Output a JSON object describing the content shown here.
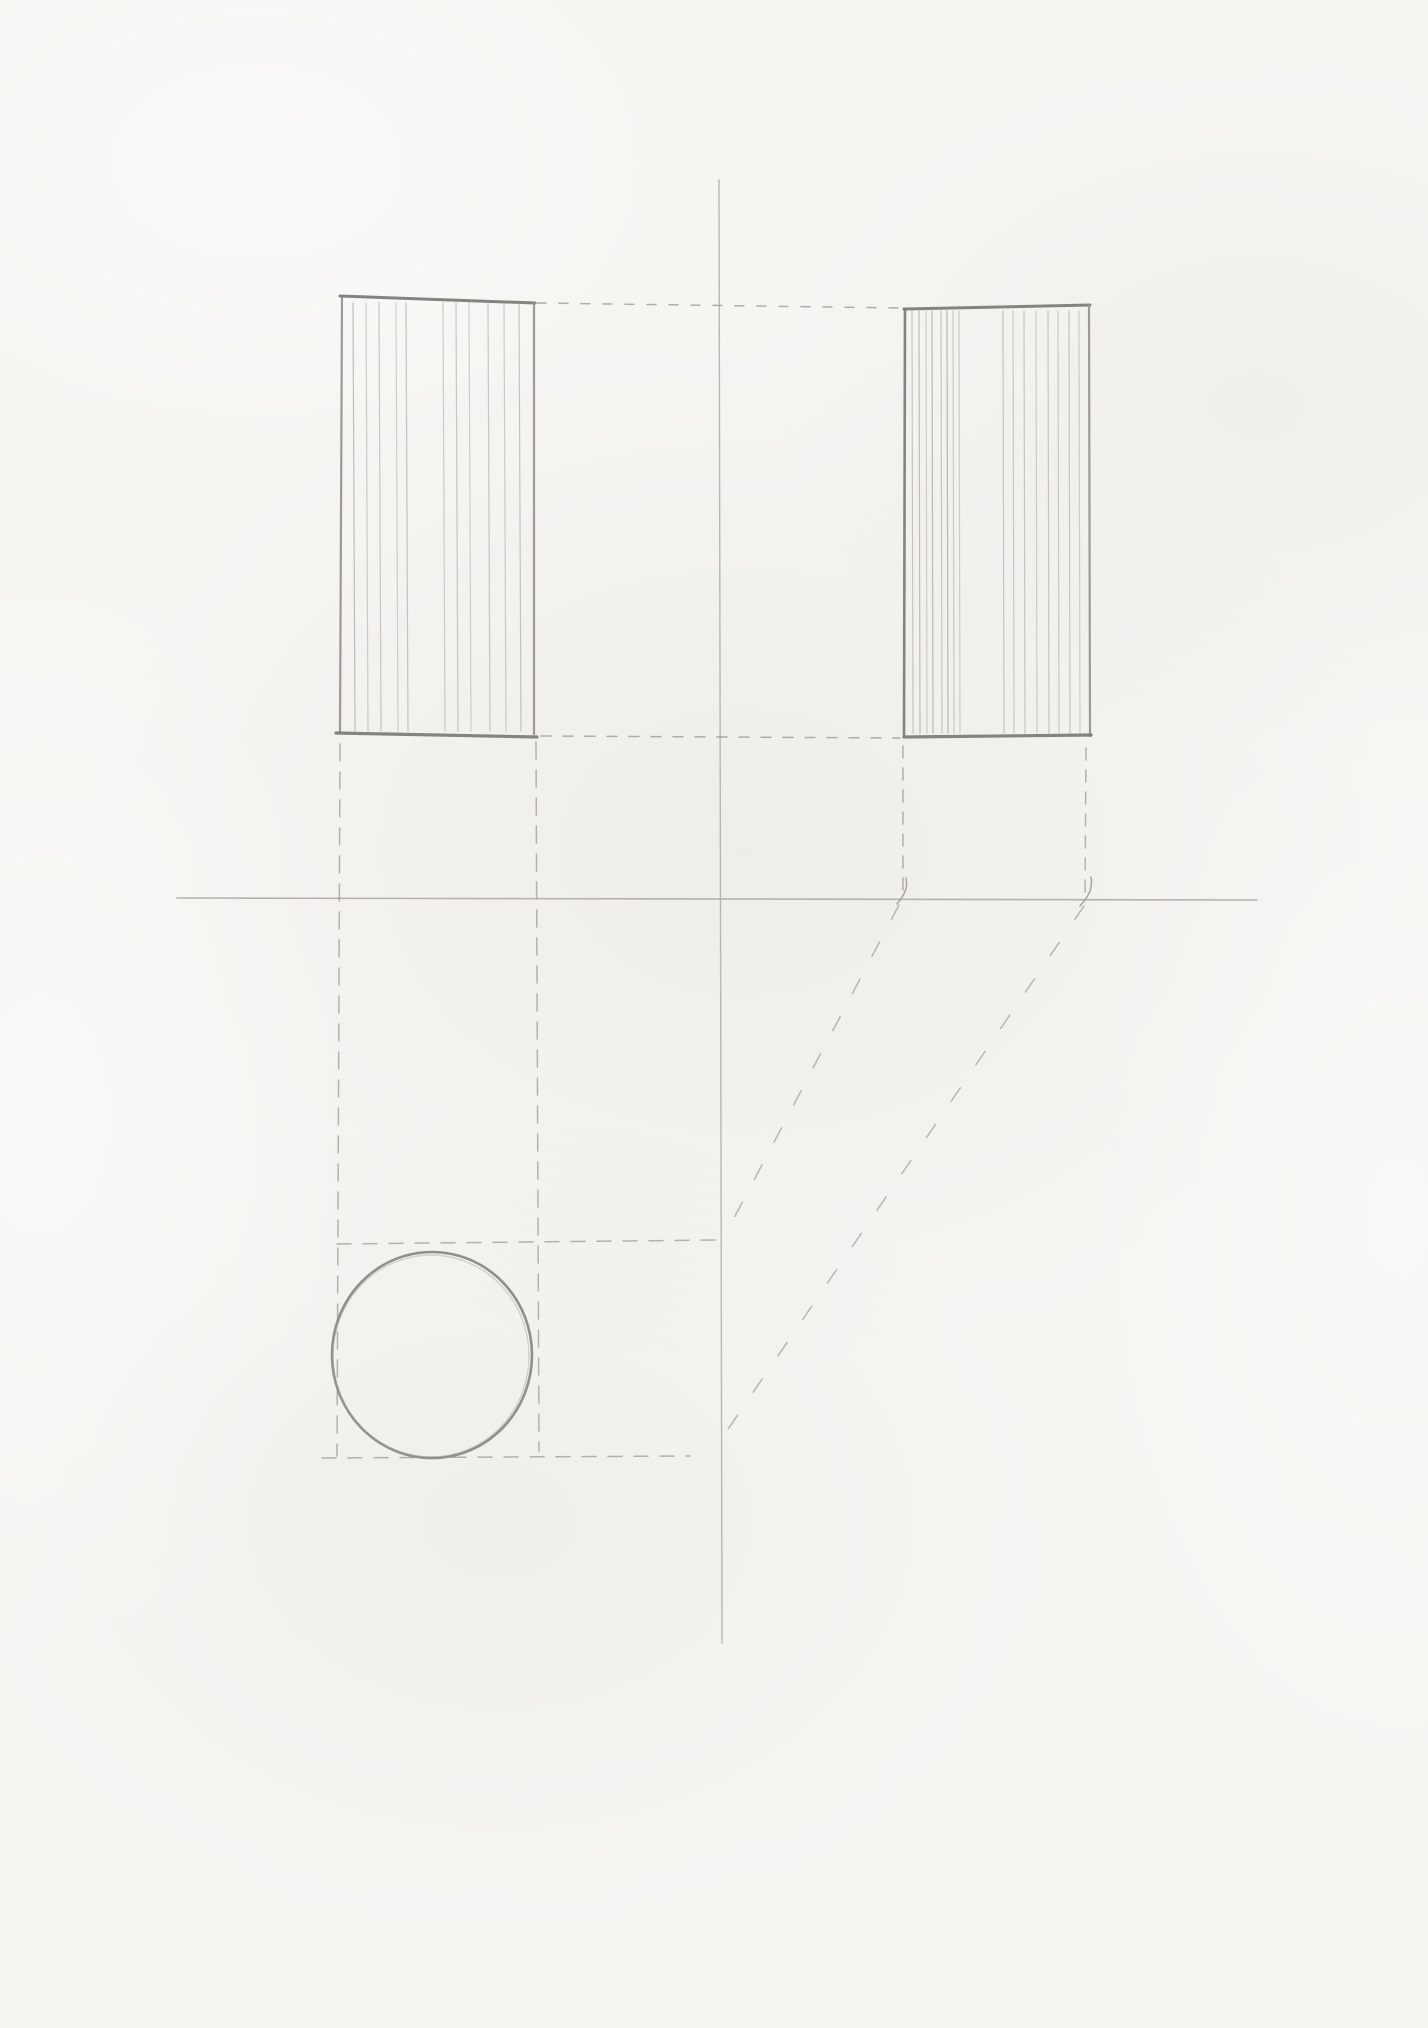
{
  "canvas": {
    "width": 1428,
    "height": 2028
  },
  "palette": {
    "paper": "#f6f5f2",
    "pencilFaint": "#c2bfba",
    "pencilLight": "#aaa7a1",
    "pencilMid": "#98958f",
    "pencilDark": "#7e7c77",
    "pencilOutline": "#8b8984"
  },
  "drawing": {
    "lines": [
      {
        "name": "ground-axis-line",
        "x1": 177,
        "y1": 898,
        "x2": 1257,
        "y2": 900,
        "c": "pencilLight",
        "w": 1.6,
        "o": 0.85
      },
      {
        "name": "vertical-axis-line",
        "x1": 719,
        "y1": 180,
        "x2": 722,
        "y2": 1643,
        "c": "pencilLight",
        "w": 1.4,
        "o": 0.8
      },
      {
        "name": "front-view-edge-left",
        "x1": 342,
        "y1": 297,
        "x2": 340,
        "y2": 733,
        "c": "pencilMid",
        "w": 2.2,
        "o": 0.95
      },
      {
        "name": "front-view-edge-top",
        "x1": 340,
        "y1": 296,
        "x2": 535,
        "y2": 303,
        "c": "pencilDark",
        "w": 3.0,
        "o": 0.95
      },
      {
        "name": "front-view-edge-right",
        "x1": 534,
        "y1": 303,
        "x2": 534,
        "y2": 734,
        "c": "pencilMid",
        "w": 2.2,
        "o": 0.95
      },
      {
        "name": "front-view-edge-bottom",
        "x1": 336,
        "y1": 733,
        "x2": 537,
        "y2": 737,
        "c": "pencilDark",
        "w": 3.2,
        "o": 0.95
      },
      {
        "name": "side-view-edge-left",
        "x1": 905,
        "y1": 309,
        "x2": 904,
        "y2": 737,
        "c": "pencilDark",
        "w": 2.6,
        "o": 0.95
      },
      {
        "name": "side-view-edge-top",
        "x1": 904,
        "y1": 309,
        "x2": 1090,
        "y2": 305,
        "c": "pencilDark",
        "w": 3.0,
        "o": 0.95
      },
      {
        "name": "side-view-edge-right",
        "x1": 1089,
        "y1": 305,
        "x2": 1090,
        "y2": 736,
        "c": "pencilMid",
        "w": 2.2,
        "o": 0.95
      },
      {
        "name": "side-view-edge-bottom",
        "x1": 904,
        "y1": 737,
        "x2": 1091,
        "y2": 735,
        "c": "pencilDark",
        "w": 3.2,
        "o": 0.95
      },
      {
        "name": "front-view-hatch-line",
        "x1": 353,
        "y1": 303,
        "x2": 355,
        "y2": 731,
        "c": "pencilLight",
        "w": 1.2,
        "o": 0.7
      },
      {
        "name": "front-view-hatch-line",
        "x1": 366,
        "y1": 303,
        "x2": 368,
        "y2": 731,
        "c": "pencilLight",
        "w": 1.2,
        "o": 0.55
      },
      {
        "name": "front-view-hatch-line",
        "x1": 379,
        "y1": 303,
        "x2": 381,
        "y2": 731,
        "c": "pencilLight",
        "w": 1.2,
        "o": 0.6
      },
      {
        "name": "front-view-hatch-line",
        "x1": 396,
        "y1": 303,
        "x2": 398,
        "y2": 731,
        "c": "pencilLight",
        "w": 1.2,
        "o": 0.5
      },
      {
        "name": "front-view-hatch-line",
        "x1": 406,
        "y1": 303,
        "x2": 408,
        "y2": 731,
        "c": "pencilLight",
        "w": 1.2,
        "o": 0.65
      },
      {
        "name": "front-view-hatch-line",
        "x1": 443,
        "y1": 303,
        "x2": 445,
        "y2": 731,
        "c": "pencilLight",
        "w": 1.2,
        "o": 0.55
      },
      {
        "name": "front-view-hatch-line",
        "x1": 456,
        "y1": 303,
        "x2": 458,
        "y2": 731,
        "c": "pencilLight",
        "w": 1.2,
        "o": 0.6
      },
      {
        "name": "front-view-hatch-line",
        "x1": 469,
        "y1": 303,
        "x2": 471,
        "y2": 731,
        "c": "pencilLight",
        "w": 1.2,
        "o": 0.5
      },
      {
        "name": "front-view-hatch-line",
        "x1": 488,
        "y1": 303,
        "x2": 490,
        "y2": 731,
        "c": "pencilLight",
        "w": 1.2,
        "o": 0.6
      },
      {
        "name": "front-view-hatch-line",
        "x1": 504,
        "y1": 303,
        "x2": 506,
        "y2": 731,
        "c": "pencilLight",
        "w": 1.2,
        "o": 0.55
      },
      {
        "name": "front-view-hatch-line",
        "x1": 519,
        "y1": 303,
        "x2": 521,
        "y2": 731,
        "c": "pencilLight",
        "w": 1.2,
        "o": 0.65
      },
      {
        "name": "side-view-hatch-line",
        "x1": 912,
        "y1": 311,
        "x2": 913,
        "y2": 733,
        "c": "pencilLight",
        "w": 1.2,
        "o": 0.6
      },
      {
        "name": "side-view-hatch-line",
        "x1": 919,
        "y1": 311,
        "x2": 920,
        "y2": 733,
        "c": "pencilLight",
        "w": 1.2,
        "o": 0.7
      },
      {
        "name": "side-view-hatch-line",
        "x1": 926,
        "y1": 311,
        "x2": 927,
        "y2": 733,
        "c": "pencilLight",
        "w": 1.2,
        "o": 0.5
      },
      {
        "name": "side-view-hatch-line",
        "x1": 932,
        "y1": 311,
        "x2": 933,
        "y2": 733,
        "c": "pencilLight",
        "w": 1.2,
        "o": 0.75
      },
      {
        "name": "side-view-hatch-line",
        "x1": 941,
        "y1": 311,
        "x2": 942,
        "y2": 733,
        "c": "pencilLight",
        "w": 1.2,
        "o": 0.6
      },
      {
        "name": "side-view-hatch-line",
        "x1": 947,
        "y1": 311,
        "x2": 948,
        "y2": 733,
        "c": "pencilLight",
        "w": 1.2,
        "o": 0.8
      },
      {
        "name": "side-view-hatch-line",
        "x1": 953,
        "y1": 311,
        "x2": 954,
        "y2": 733,
        "c": "pencilLight",
        "w": 1.2,
        "o": 0.55
      },
      {
        "name": "side-view-hatch-line",
        "x1": 959,
        "y1": 311,
        "x2": 960,
        "y2": 733,
        "c": "pencilLight",
        "w": 1.2,
        "o": 0.5
      },
      {
        "name": "side-view-hatch-line",
        "x1": 1003,
        "y1": 311,
        "x2": 1004,
        "y2": 733,
        "c": "pencilLight",
        "w": 1.2,
        "o": 0.6
      },
      {
        "name": "side-view-hatch-line",
        "x1": 1013,
        "y1": 311,
        "x2": 1014,
        "y2": 733,
        "c": "pencilLight",
        "w": 1.2,
        "o": 0.55
      },
      {
        "name": "side-view-hatch-line",
        "x1": 1024,
        "y1": 311,
        "x2": 1025,
        "y2": 733,
        "c": "pencilLight",
        "w": 1.2,
        "o": 0.6
      },
      {
        "name": "side-view-hatch-line",
        "x1": 1036,
        "y1": 311,
        "x2": 1037,
        "y2": 733,
        "c": "pencilLight",
        "w": 1.2,
        "o": 0.5
      },
      {
        "name": "side-view-hatch-line",
        "x1": 1048,
        "y1": 311,
        "x2": 1049,
        "y2": 733,
        "c": "pencilLight",
        "w": 1.2,
        "o": 0.6
      },
      {
        "name": "side-view-hatch-line",
        "x1": 1058,
        "y1": 311,
        "x2": 1059,
        "y2": 733,
        "c": "pencilLight",
        "w": 1.2,
        "o": 0.55
      },
      {
        "name": "side-view-hatch-line",
        "x1": 1069,
        "y1": 311,
        "x2": 1070,
        "y2": 733,
        "c": "pencilLight",
        "w": 1.2,
        "o": 0.6
      },
      {
        "name": "side-view-hatch-line",
        "x1": 1079,
        "y1": 311,
        "x2": 1080,
        "y2": 733,
        "c": "pencilLight",
        "w": 1.2,
        "o": 0.5
      },
      {
        "name": "projection-line-top-connector",
        "x1": 537,
        "y1": 303,
        "x2": 902,
        "y2": 308,
        "c": "pencilMid",
        "w": 1.5,
        "o": 0.75,
        "dash": "9 13"
      },
      {
        "name": "projection-line-bottom-connector",
        "x1": 541,
        "y1": 736,
        "x2": 900,
        "y2": 738,
        "c": "pencilMid",
        "w": 1.5,
        "o": 0.75,
        "dash": "10 12"
      },
      {
        "name": "projection-line-front-left-down",
        "x1": 340,
        "y1": 744,
        "x2": 337,
        "y2": 1456,
        "c": "pencilMid",
        "w": 1.5,
        "o": 0.7,
        "dash": "17 11"
      },
      {
        "name": "projection-line-front-right-down",
        "x1": 536,
        "y1": 742,
        "x2": 539,
        "y2": 1451,
        "c": "pencilMid",
        "w": 1.5,
        "o": 0.7,
        "dash": "17 11"
      },
      {
        "name": "projection-line-side-left-down",
        "x1": 903,
        "y1": 746,
        "x2": 903,
        "y2": 896,
        "c": "pencilMid",
        "w": 1.5,
        "o": 0.7,
        "dash": "12 10"
      },
      {
        "name": "projection-line-side-right-down",
        "x1": 1086,
        "y1": 748,
        "x2": 1085,
        "y2": 896,
        "c": "pencilMid",
        "w": 1.5,
        "o": 0.7,
        "dash": "12 10"
      },
      {
        "name": "projection-line-top-tangent",
        "x1": 337,
        "y1": 1244,
        "x2": 717,
        "y2": 1240,
        "c": "pencilMid",
        "w": 1.5,
        "o": 0.7,
        "dash": "14 12"
      },
      {
        "name": "projection-line-bottom-tangent",
        "x1": 322,
        "y1": 1458,
        "x2": 690,
        "y2": 1456,
        "c": "pencilMid",
        "w": 1.5,
        "o": 0.7,
        "dash": "14 12"
      },
      {
        "name": "transfer-line-diagonal-left",
        "x1": 899,
        "y1": 905,
        "x2": 724,
        "y2": 1237,
        "c": "pencilMid",
        "w": 1.5,
        "o": 0.65,
        "dash": "16 26"
      },
      {
        "name": "transfer-line-diagonal-right",
        "x1": 1084,
        "y1": 906,
        "x2": 720,
        "y2": 1441,
        "c": "pencilMid",
        "w": 1.5,
        "o": 0.65,
        "dash": "16 28"
      }
    ],
    "ellipses": [
      {
        "name": "top-view-circle",
        "cx": 432,
        "cy": 1355,
        "rx": 100,
        "ry": 103,
        "c": "pencilOutline",
        "w": 2.6,
        "o": 0.95
      },
      {
        "name": "top-view-circle-overdraw",
        "cx": 431,
        "cy": 1356,
        "rx": 98,
        "ry": 101,
        "c": "pencilLight",
        "w": 1.4,
        "o": 0.45
      }
    ],
    "paths": [
      {
        "name": "crossing-tick-left",
        "d": "M 906 878 C 908 888 905 894 897 904",
        "c": "pencilMid",
        "w": 1.6,
        "o": 0.8
      },
      {
        "name": "crossing-tick-right",
        "d": "M 1091 877 C 1093 888 1089 896 1080 906",
        "c": "pencilMid",
        "w": 1.6,
        "o": 0.8
      }
    ],
    "dots": [
      {
        "name": "top-view-center-mark",
        "cx": 433,
        "cy": 1356,
        "r": 1.8,
        "c": "pencilMid",
        "o": 0.85
      },
      {
        "name": "paper-speck",
        "cx": 732,
        "cy": 238,
        "r": 1.4,
        "c": "pencilLight",
        "o": 0.5
      },
      {
        "name": "paper-speck",
        "cx": 248,
        "cy": 922,
        "r": 1.3,
        "c": "pencilLight",
        "o": 0.45
      },
      {
        "name": "paper-speck",
        "cx": 402,
        "cy": 1349,
        "r": 1.1,
        "c": "pencilFaint",
        "o": 0.4
      },
      {
        "name": "paper-speck",
        "cx": 879,
        "cy": 1035,
        "r": 1.2,
        "c": "pencilFaint",
        "o": 0.35
      }
    ]
  }
}
